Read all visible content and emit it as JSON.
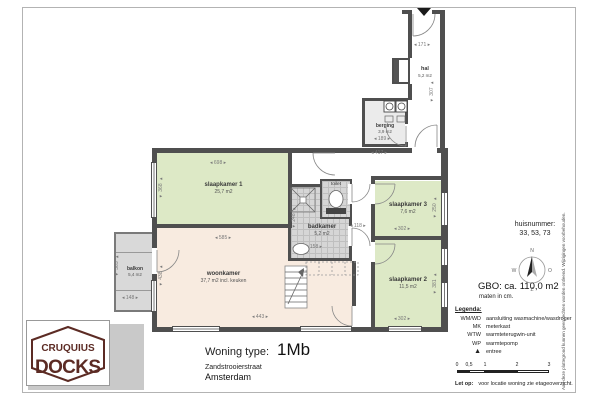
{
  "colors": {
    "bedroom_green": "#dde9c6",
    "living_beige": "#f8ebe0",
    "tile_gray": "#d6d6d6",
    "wall": "#4f4f4f",
    "balcony_gray": "#d9d9d9",
    "logo_maroon": "#5c2b24"
  },
  "logo": {
    "line1": "CRUQUIUS",
    "line2": "DOCKS"
  },
  "title_block": {
    "label": "Woning type:",
    "value": "1Mb",
    "street": "Zandstrooierstraat",
    "city": "Amsterdam"
  },
  "info": {
    "huisnummer_label": "huisnummer:",
    "huisnummer_values": "33, 53, 73",
    "gbo": "GBO: ca. 110,0 m2",
    "units_note": "maten in cm."
  },
  "compass": {
    "n": "N",
    "e": "O",
    "s": "Z",
    "w": "W"
  },
  "rooms": {
    "slaapkamer1": {
      "name": "slaapkamer 1",
      "area": "25,7 m2"
    },
    "woonkamer": {
      "name": "woonkamer",
      "area": "37,7 m2 incl. keuken"
    },
    "slaapkamer2": {
      "name": "slaapkamer 2",
      "area": "11,5 m2"
    },
    "slaapkamer3": {
      "name": "slaapkamer 3",
      "area": "7,6 m2"
    },
    "badkamer": {
      "name": "badkamer",
      "area": "5,2 m2"
    },
    "toilet": {
      "name": "toilet"
    },
    "berging": {
      "name": "berging",
      "area": "3,9 m2"
    },
    "hal": {
      "name": "hal",
      "area": "5,2 m2"
    },
    "balkon": {
      "name": "balkon",
      "area": "5,4 m2"
    }
  },
  "dims": {
    "sk1_w": "698",
    "sk1_h": "368",
    "wk_w": "585",
    "wk_h": "438",
    "wk_b": "443",
    "sk3_w": "302",
    "sk3_h": "250",
    "sk2_w": "302",
    "sk2_h": "381",
    "balkon_w": "148",
    "balkon_h": "365",
    "badkamer_w": "158",
    "badkamer_h": "248",
    "hall_w": "118",
    "hal_w": "171",
    "hal_h": "307",
    "berging_w": "189",
    "berging_total": "417"
  },
  "legend": {
    "heading": "Legenda:",
    "items": [
      {
        "abbr": "WM/WD",
        "desc": "aansluiting wasmachine/wasdroger"
      },
      {
        "abbr": "MK",
        "desc": "meterkast"
      },
      {
        "abbr": "WTW",
        "desc": "warmteterugwin-unit"
      },
      {
        "abbr": "WP",
        "desc": "warmtepomp"
      },
      {
        "abbr": "▲",
        "desc": "entree"
      }
    ],
    "scale_ticks": [
      "0",
      "0,5",
      "1",
      "2",
      "3"
    ],
    "note_label": "Let op:",
    "note_text": "voor locatie woning zie etageoverzicht."
  },
  "disclaimer": "Aan deze plattegrond kunnen geen rechten worden ontleend. Wijzigingen voorbehouden."
}
